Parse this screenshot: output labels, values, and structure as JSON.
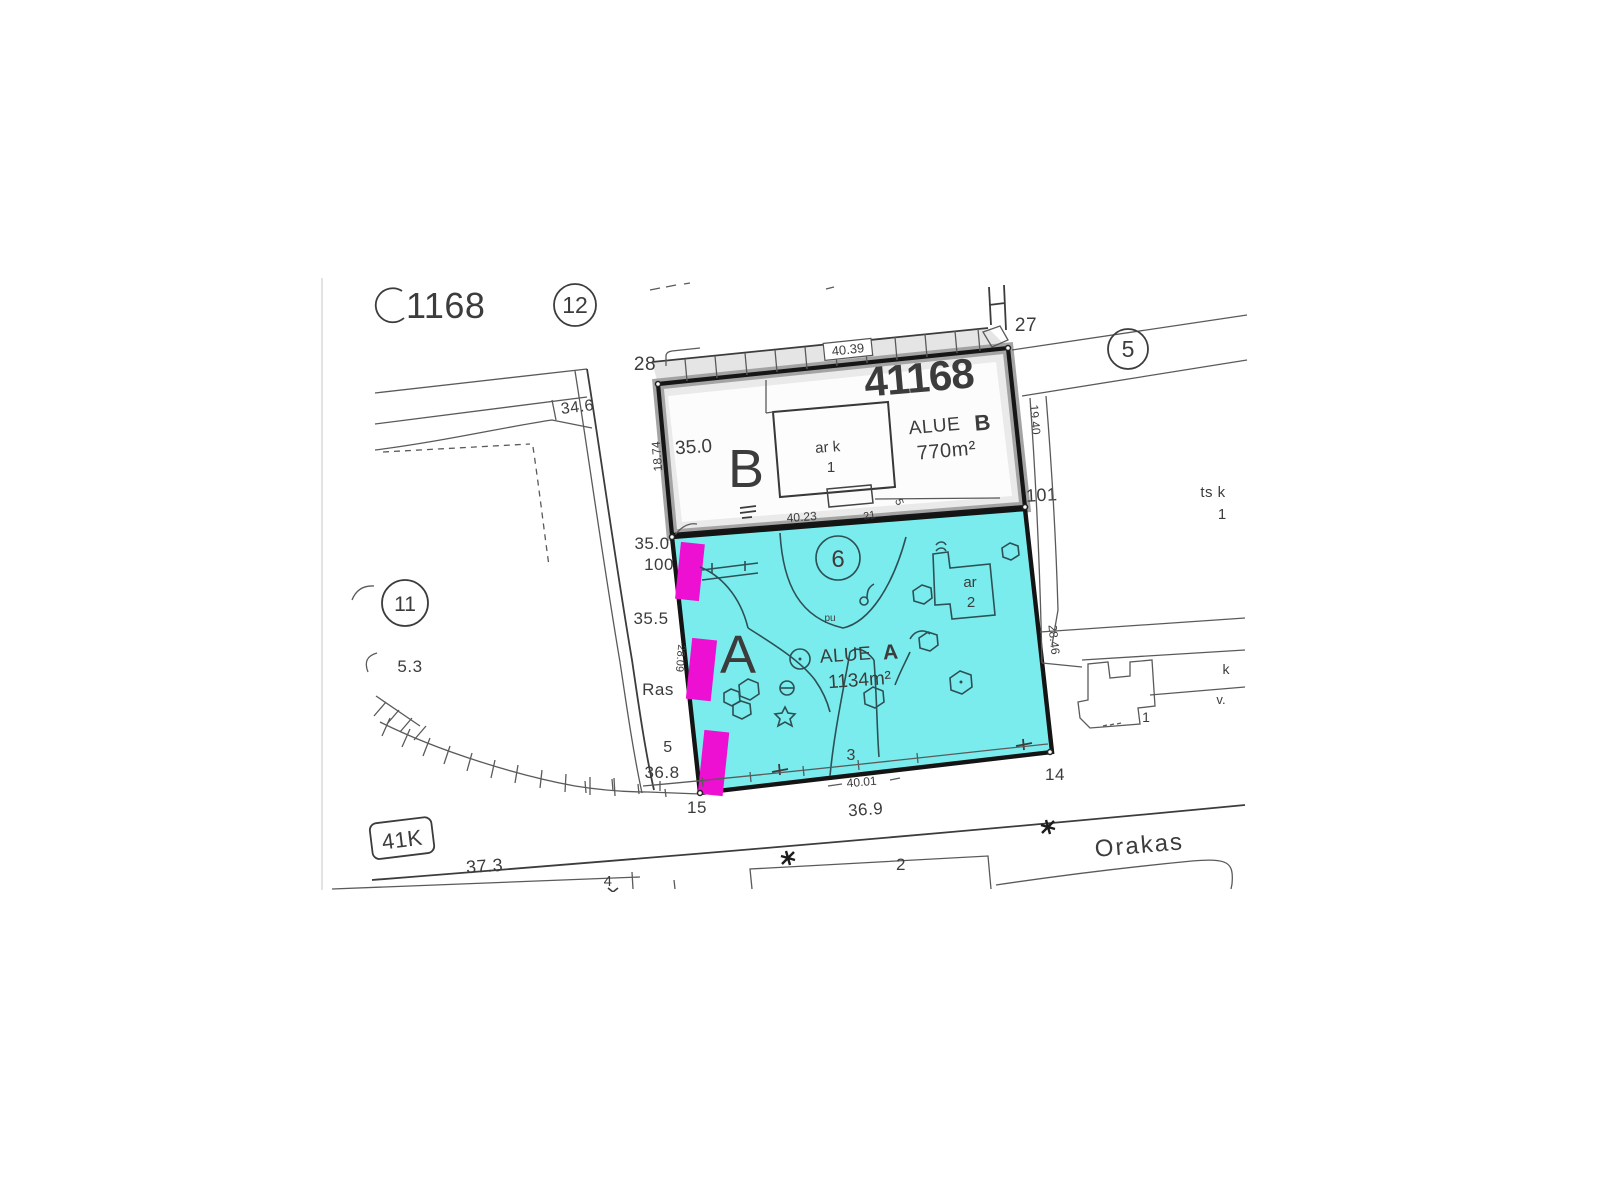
{
  "map": {
    "labels": {
      "top_plot": "1168",
      "circle12": "12",
      "circle5": "5",
      "circle11": "11",
      "circle6": "6",
      "corner28": "28",
      "corner27": "27",
      "corner101": "101",
      "corner100": "100",
      "corner15": "15",
      "corner14": "14",
      "title": "41168",
      "alue_b": "ALUE",
      "alue_b_letter": "B",
      "area_b": "770m²",
      "big_b": "B",
      "big_a": "A",
      "bldg_b": "ar k",
      "bldg_b_num": "1",
      "contour_b": "35.0",
      "dim_top": "40.39",
      "dim_b_bottom": "40.23",
      "small21": "21",
      "small5": "5",
      "dim_b_left": "18.74",
      "dim_b_right": "19.40",
      "alue_a": "ALUE",
      "alue_a_letter": "A",
      "area_a": "1134m²",
      "bldg_a": "ar",
      "bldg_a_num": "2",
      "pu": "pu",
      "num3": "3",
      "dim_a_bottom": "40.01",
      "dim_a_left": "28.09",
      "dim_a_right": "28.46",
      "elev34_6": "34.6",
      "elev35_0": "35.0",
      "elev35_5": "35.5",
      "ras": "Ras",
      "elev5": "5",
      "elev36_8": "36.8",
      "elev36_9": "36.9",
      "elev37_3": "37.3",
      "elev5_3": "5.3",
      "block41k": "41K",
      "street_name": "Orakas",
      "road2": "2",
      "road4": "4",
      "ts_k": "ts k",
      "ts_k_num": "1",
      "right_k": "k",
      "right_v": "v.",
      "right_bldg_num": "1"
    },
    "colors": {
      "area_a_fill": "#7beced",
      "marker_magenta": "#ee10d2",
      "plot_border": "#161616",
      "ink": "#3c3c3c",
      "teal_ink": "#2d5054",
      "label_dark": "#1d3b45",
      "shade_gray": "#cfcfcf"
    }
  }
}
